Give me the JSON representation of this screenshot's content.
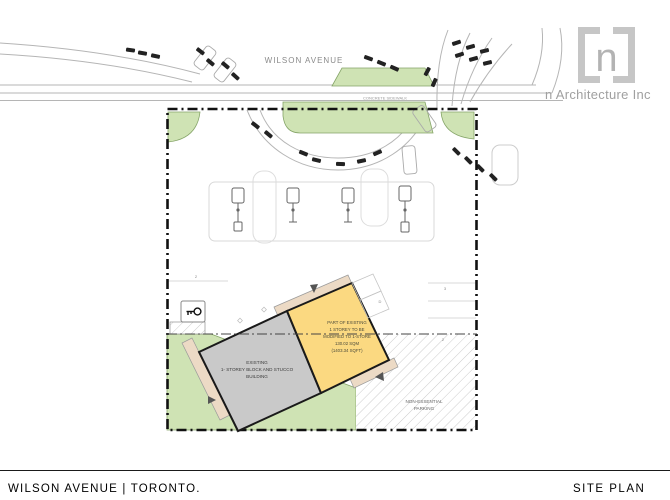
{
  "branding": {
    "logo_letter": "n",
    "company": "n Architecture Inc"
  },
  "titleblock": {
    "project": "WILSON AVENUE | TORONTO.",
    "sheet_title": "SITE PLAN"
  },
  "plan": {
    "street": "WILSON AVENUE",
    "sidewalk": "CONCRETE SIDEWALK",
    "existing_building": [
      "EXISTING",
      "1- STOREY BLOCK AND STUCCO",
      "BUILDING"
    ],
    "modified_building": [
      "PART OF EXISTING",
      "1 STOREY TO BE",
      "MODIFIED TO 1-STORE",
      "130.02 SQM",
      "(1403.34 SQFT)"
    ],
    "parking_area": [
      "NON-ESSENTIAL",
      "PARKING"
    ],
    "stall_labels": {
      "left": "2",
      "right_top": "3",
      "right_bottom": "2",
      "extension": "D"
    }
  },
  "colors": {
    "green": "#cfe3b4",
    "green_edge": "#85a468",
    "yellow": "#fbd981",
    "building_gray": "#c9c9c9",
    "tan": "#ecdac5",
    "outline": "#1a1a1a",
    "road_gray": "#b5b5b5"
  }
}
